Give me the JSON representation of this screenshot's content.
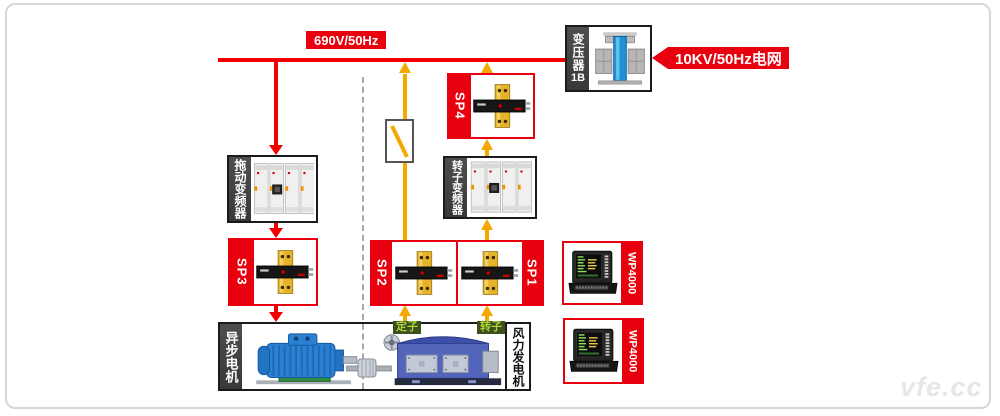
{
  "labels": {
    "bus": "690V/50Hz",
    "grid": "10KV/50Hz电网",
    "transformer": "变压器",
    "transformer_id": "1B",
    "drive_inverter": "拖动变频器",
    "rotor_inverter": "转子变频器",
    "sp1": "SP1",
    "sp2": "SP2",
    "sp3": "SP3",
    "sp4": "SP4",
    "wp_upper": "WP4000",
    "wp_lower": "WP4000",
    "motor": "异步电机",
    "generator": "风力发电机",
    "stator": "定子",
    "rotor": "转子",
    "watermark": "vfe.cc"
  },
  "colors": {
    "line_red": "#f20000",
    "label_red": "#e8000f",
    "arrow_yellow": "#f5a800",
    "dark_strip": "#424242",
    "green_tag_bg": "#3c4f1d",
    "green_tag_text": "#a9d636"
  }
}
